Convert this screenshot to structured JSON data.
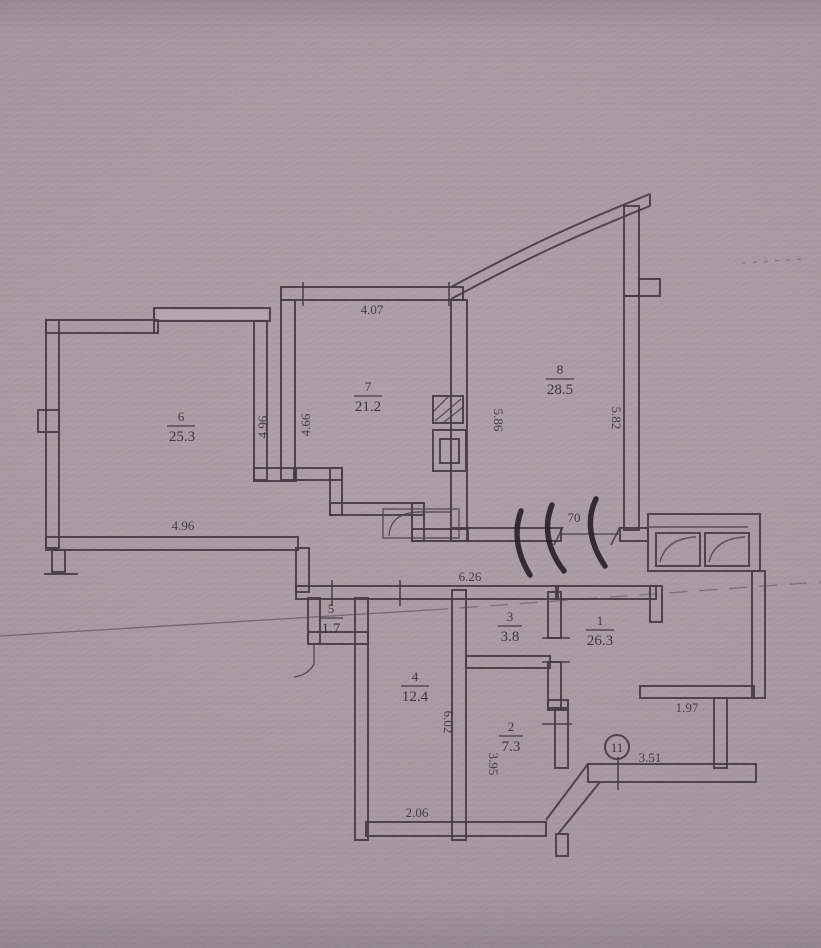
{
  "plan": {
    "rooms": [
      {
        "number": "1",
        "area": "26.3"
      },
      {
        "number": "2",
        "area": "7.3"
      },
      {
        "number": "3",
        "area": "3.8"
      },
      {
        "number": "4",
        "area": "12.4"
      },
      {
        "number": "5",
        "area": "1.7"
      },
      {
        "number": "6",
        "area": "25.3"
      },
      {
        "number": "7",
        "area": "21.2"
      },
      {
        "number": "8",
        "area": "28.5"
      }
    ],
    "dimensions": {
      "room7_top": "4.07",
      "room6_right_wall": "4.96",
      "room7_left_wall": "4.66",
      "room8_left_wall": "5.86",
      "room8_right_wall": "5.82",
      "room6_bottom": "4.96",
      "corridor_top": "6.26",
      "hall_partition": "70",
      "room4_left_wall": "6.02",
      "room2_left_wall": "3.95",
      "room4_bottom": "2.06",
      "hall_niche": "1.97",
      "entry_wall": "3.51"
    },
    "markers": {
      "entry_circle": "11"
    },
    "colors": {
      "paper": "#ab9fa5",
      "ink": "#443a40",
      "pen": "#1e151b"
    }
  }
}
